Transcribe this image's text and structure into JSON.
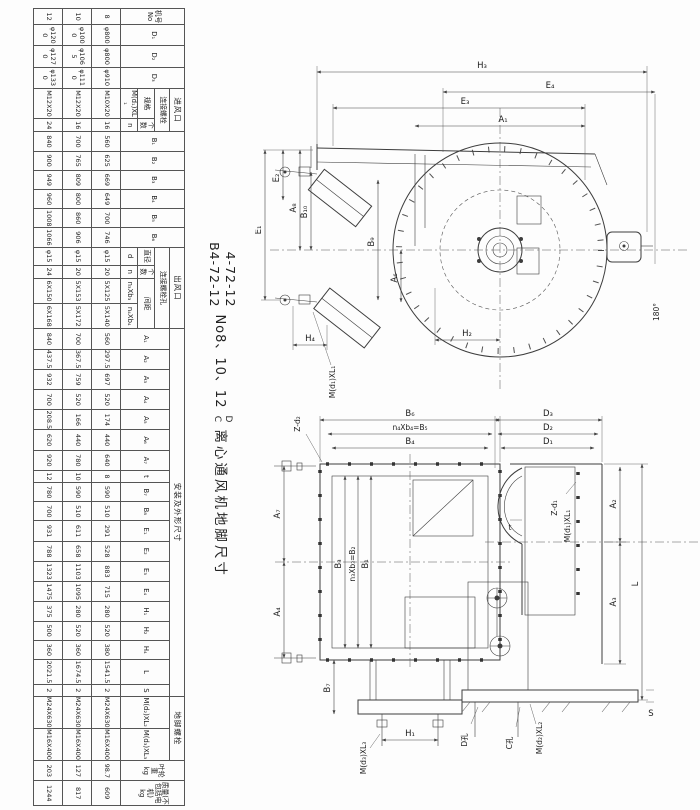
{
  "title": {
    "model1": "4-72-12",
    "model2": "B4-72-12",
    "sizes": "No8、10、12",
    "variant1": "D",
    "variant2": "C",
    "text": "离心通风机地脚尺寸"
  },
  "table": {
    "h": {
      "jihao": "机号",
      "no": "No",
      "d1": "D₁",
      "d2": "D₂",
      "d3": "D₃",
      "inlet": "进风口",
      "inlet_bolt": "连接螺栓",
      "spec": "规格",
      "count": "个数",
      "m_d1": "M(d₁)XL₁",
      "n": "n",
      "b1": "B₁",
      "b2": "B₂",
      "b3": "B₃",
      "b4": "B₄",
      "b5": "B₅",
      "b6": "B₆",
      "outlet": "出风口",
      "outlet_holes": "连接螺栓孔",
      "dia": "直径",
      "d": "d",
      "count2": "个数",
      "n2": "n",
      "spacing": "间距",
      "n3b3": "n₃Xb₃",
      "n4b4": "n₄Xb₄",
      "install": "安装及外形尺寸",
      "a1": "A₁",
      "a2": "A₂",
      "a3": "A₃",
      "a4": "A₄",
      "a5": "A₅",
      "a6": "A₆",
      "a7": "A₇",
      "t": "t",
      "b7": "B₇",
      "b8": "B₈",
      "e1": "E₁",
      "e2": "E₂",
      "e3": "E₃",
      "e4": "E₄",
      "h1": "H₁",
      "h2": "H₂",
      "h4": "H₄",
      "l": "L",
      "s": "S",
      "anchor": "地脚螺栓",
      "m_d2": "M(d₂)XL₂",
      "m_d3": "M(d₃)XL₃",
      "impeller": "叶轮重",
      "kg": "kg",
      "mass": "质量(不包括电机)",
      "kg2": "kg"
    },
    "rows": [
      {
        "cells": [
          "8",
          "φ800",
          "φ800",
          "φ910",
          "M10X20",
          "16",
          "560",
          "625",
          "669",
          "649",
          "700",
          "746",
          "φ15",
          "20",
          "5X125",
          "5X140",
          "560",
          "297.5",
          "697",
          "520",
          "174",
          "440",
          "640",
          "8",
          "590",
          "510",
          "291",
          "528",
          "883",
          "715",
          "280",
          "520",
          "380",
          "1541.5",
          "2",
          "M24X630",
          "M16X400",
          "98.7",
          "609"
        ]
      },
      {
        "cells": [
          "10",
          "φ1000",
          "φ1065",
          "φ1110",
          "M12X20",
          "16",
          "700",
          "765",
          "809",
          "800",
          "860",
          "906",
          "φ15",
          "20",
          "5X153",
          "5X172",
          "700",
          "367.5",
          "759",
          "520",
          "166",
          "440",
          "780",
          "10",
          "590",
          "510",
          "611",
          "658",
          "1103",
          "1095",
          "280",
          "520",
          "360",
          "1674.5",
          "2",
          "M24X630",
          "M16X400",
          "127",
          "817"
        ]
      },
      {
        "cells": [
          "12",
          "φ1200",
          "φ1270",
          "φ1330",
          "M12X20",
          "24",
          "840",
          "900",
          "949",
          "960",
          "1008",
          "1066",
          "φ15",
          "24",
          "6X150",
          "6X168",
          "840",
          "437.5",
          "932",
          "700",
          "208.5",
          "620",
          "920",
          "12",
          "780",
          "700",
          "931",
          "788",
          "1323",
          "1475",
          "375",
          "500",
          "360",
          "2021.5",
          "2",
          "M24X630",
          "M16X400",
          "203",
          "1244"
        ]
      }
    ]
  },
  "dtop": {
    "h3": "H₃",
    "e4": "E₄",
    "e3": "E₃",
    "a1": "A₁",
    "e2": "E₂",
    "a8": "A₈",
    "e1": "E₁",
    "b10": "B₁₀",
    "b9": "B₉",
    "a6": "A₆",
    "h4": "H₄",
    "h2": "H₂",
    "md1": "M(d₁)XL₁",
    "angle": "180°"
  },
  "dbot": {
    "b6": "B₆",
    "b5": "n₄Xb₄=B₅",
    "b4": "B₄",
    "zd2": "Z-d₂",
    "a7": "A₇",
    "a4": "A₄",
    "b3": "B₃",
    "b2": "n₃Xb₃=B₂",
    "b1": "B₁",
    "b7": "B₇",
    "h1": "H₁",
    "md3": "M(d₃)XL₃",
    "md2": "M(d₂)XL₂",
    "dhole": "D孔",
    "chole": "C孔",
    "d3": "D₃",
    "d2": "D₂",
    "d1": "D₁",
    "zd1": "Z-d₁",
    "md1": "M(d₁)XL₁",
    "t": "t",
    "a2": "A₂",
    "a3": "A₃",
    "l": "L",
    "s": "S"
  }
}
